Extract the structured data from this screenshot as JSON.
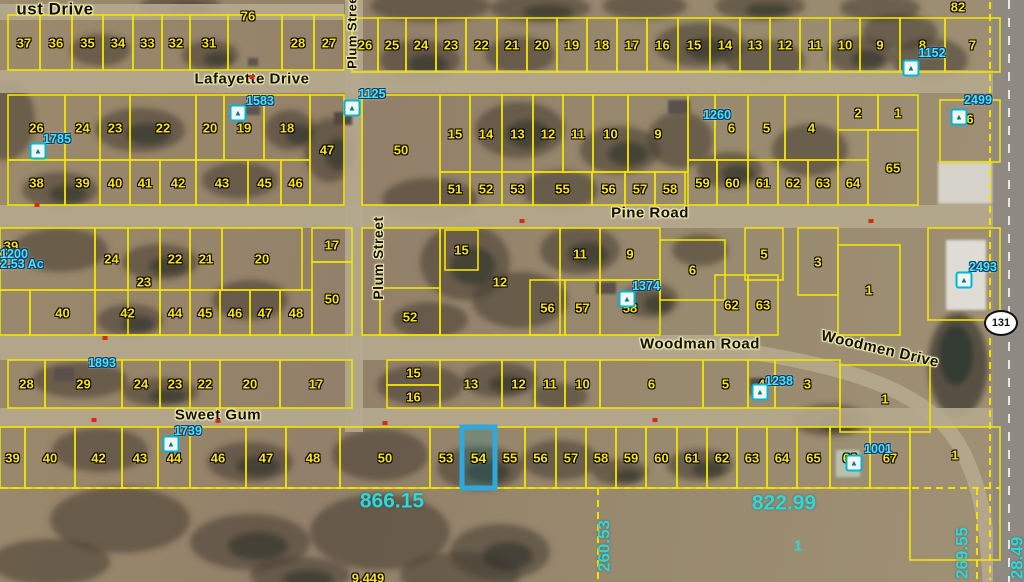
{
  "map": {
    "colors": {
      "parcel_line": "#f2e400",
      "parcel_number": "#ffe600",
      "annotation": "#49e6f5",
      "measurement": "#2ed8d8",
      "highlight": "#2fa8dc",
      "road": "#b5a88e"
    },
    "street_labels": [
      {
        "text": "ust Drive",
        "x": 55,
        "y": 9,
        "size": 17,
        "rot": 0
      },
      {
        "text": "Lafayette Drive",
        "x": 252,
        "y": 79,
        "size": 15,
        "rot": 0
      },
      {
        "text": "Pine Road",
        "x": 650,
        "y": 213,
        "size": 15,
        "rot": 0
      },
      {
        "text": "Woodman Road",
        "x": 700,
        "y": 344,
        "size": 15,
        "rot": 0
      },
      {
        "text": "Woodmen Drive",
        "x": 880,
        "y": 349,
        "size": 15,
        "rot": 13
      },
      {
        "text": "Sweet Gum",
        "x": 218,
        "y": 415,
        "size": 15,
        "rot": 0
      },
      {
        "text": "Plum Street",
        "x": 352,
        "y": 30,
        "size": 13,
        "rot": -90
      },
      {
        "text": "Plum Street",
        "x": 378,
        "y": 258,
        "size": 14,
        "rot": -90
      }
    ],
    "parcel_rows": [
      {
        "y1": 15,
        "y2": 70,
        "cells": [
          [
            8,
            40,
            "37"
          ],
          [
            40,
            72,
            "36"
          ],
          [
            72,
            103,
            "35"
          ],
          [
            103,
            133,
            "34"
          ],
          [
            133,
            162,
            "33"
          ],
          [
            162,
            190,
            "32"
          ],
          [
            190,
            228,
            "31"
          ],
          [
            228,
            282,
            ""
          ],
          [
            282,
            314,
            "28"
          ],
          [
            314,
            344,
            "27"
          ]
        ]
      },
      {
        "y1": 18,
        "y2": 72,
        "cells": [
          [
            352,
            378,
            "26"
          ],
          [
            378,
            406,
            "25"
          ],
          [
            406,
            436,
            "24"
          ],
          [
            436,
            466,
            "23"
          ],
          [
            466,
            497,
            "22"
          ],
          [
            497,
            527,
            "21"
          ],
          [
            527,
            557,
            "20"
          ],
          [
            557,
            587,
            "19"
          ],
          [
            587,
            617,
            "18"
          ],
          [
            617,
            647,
            "17"
          ],
          [
            647,
            678,
            "16"
          ],
          [
            678,
            710,
            "15"
          ],
          [
            710,
            740,
            "14"
          ],
          [
            740,
            770,
            "13"
          ],
          [
            770,
            800,
            "12"
          ],
          [
            800,
            830,
            "11"
          ],
          [
            830,
            860,
            "10"
          ],
          [
            860,
            900,
            "9"
          ],
          [
            900,
            945,
            "8"
          ],
          [
            945,
            1000,
            "7"
          ]
        ]
      },
      {
        "y1": 95,
        "y2": 160,
        "cells": [
          [
            8,
            65,
            "26"
          ],
          [
            65,
            100,
            "24"
          ],
          [
            100,
            130,
            "23"
          ],
          [
            130,
            196,
            "22"
          ],
          [
            196,
            224,
            "20"
          ],
          [
            224,
            264,
            "19"
          ],
          [
            264,
            310,
            "18"
          ]
        ]
      },
      {
        "y1": 95,
        "y2": 205,
        "cells": [
          [
            310,
            344,
            "47"
          ],
          [
            362,
            440,
            "50"
          ]
        ]
      },
      {
        "y1": 160,
        "y2": 205,
        "cells": [
          [
            8,
            65,
            "38"
          ],
          [
            65,
            100,
            "39"
          ],
          [
            100,
            130,
            "40"
          ],
          [
            130,
            160,
            "41"
          ],
          [
            160,
            196,
            "42"
          ],
          [
            196,
            248,
            "43"
          ],
          [
            248,
            281,
            "45"
          ],
          [
            281,
            310,
            "46"
          ]
        ]
      },
      {
        "y1": 95,
        "y2": 172,
        "cells": [
          [
            440,
            470,
            "15"
          ],
          [
            470,
            502,
            "14"
          ],
          [
            502,
            533,
            "13"
          ],
          [
            533,
            563,
            "12"
          ],
          [
            563,
            593,
            "11"
          ],
          [
            593,
            628,
            "10"
          ],
          [
            628,
            688,
            "9"
          ]
        ]
      },
      {
        "y1": 172,
        "y2": 205,
        "cells": [
          [
            440,
            470,
            "51"
          ],
          [
            470,
            502,
            "52"
          ],
          [
            502,
            533,
            "53"
          ],
          [
            533,
            592,
            "55"
          ],
          [
            592,
            625,
            "56"
          ],
          [
            625,
            655,
            "57"
          ],
          [
            655,
            685,
            "58"
          ]
        ]
      },
      {
        "y1": 95,
        "y2": 160,
        "cells": [
          [
            688,
            715,
            ""
          ],
          [
            715,
            748,
            "6"
          ],
          [
            748,
            785,
            "5"
          ],
          [
            785,
            838,
            "4"
          ]
        ]
      },
      {
        "y1": 95,
        "y2": 130,
        "cells": [
          [
            838,
            878,
            "2"
          ],
          [
            878,
            918,
            "1"
          ]
        ]
      },
      {
        "y1": 130,
        "y2": 205,
        "cells": [
          [
            868,
            918,
            "65"
          ]
        ]
      },
      {
        "y1": 160,
        "y2": 205,
        "cells": [
          [
            688,
            717,
            "59"
          ],
          [
            717,
            748,
            "60"
          ],
          [
            748,
            778,
            "61"
          ],
          [
            778,
            808,
            "62"
          ],
          [
            808,
            838,
            "63"
          ],
          [
            838,
            868,
            "64"
          ]
        ]
      },
      {
        "y1": 100,
        "y2": 162,
        "cells": [
          [
            940,
            1000,
            "6",
            119
          ]
        ]
      },
      {
        "y1": 228,
        "y2": 290,
        "cells": [
          [
            0,
            95,
            ""
          ],
          [
            95,
            128,
            "24"
          ],
          [
            160,
            190,
            "22"
          ],
          [
            190,
            222,
            "21"
          ],
          [
            222,
            302,
            "20"
          ]
        ]
      },
      {
        "y1": 228,
        "y2": 335,
        "cells": [
          [
            128,
            160,
            "23"
          ],
          [
            362,
            440,
            ""
          ],
          [
            440,
            560,
            "12"
          ]
        ]
      },
      {
        "y1": 228,
        "y2": 262,
        "cells": [
          [
            312,
            352,
            "17"
          ]
        ]
      },
      {
        "y1": 262,
        "y2": 335,
        "cells": [
          [
            312,
            352,
            "50"
          ]
        ]
      },
      {
        "y1": 290,
        "y2": 335,
        "cells": [
          [
            0,
            30,
            ""
          ],
          [
            30,
            95,
            "40"
          ],
          [
            95,
            160,
            "42"
          ],
          [
            160,
            190,
            "44"
          ],
          [
            190,
            220,
            "45"
          ],
          [
            220,
            250,
            "46"
          ],
          [
            250,
            280,
            "47"
          ],
          [
            280,
            312,
            "48"
          ]
        ]
      },
      {
        "y1": 288,
        "y2": 335,
        "cells": [
          [
            380,
            440,
            "52",
            317
          ]
        ]
      },
      {
        "y1": 230,
        "y2": 270,
        "cells": [
          [
            445,
            478,
            "15"
          ]
        ]
      },
      {
        "y1": 228,
        "y2": 280,
        "cells": [
          [
            560,
            600,
            "11"
          ],
          [
            600,
            660,
            "9"
          ],
          [
            745,
            783,
            "5"
          ]
        ]
      },
      {
        "y1": 240,
        "y2": 300,
        "cells": [
          [
            660,
            725,
            "6"
          ]
        ]
      },
      {
        "y1": 280,
        "y2": 335,
        "cells": [
          [
            530,
            565,
            "56"
          ],
          [
            565,
            600,
            "57"
          ],
          [
            600,
            660,
            "58"
          ]
        ]
      },
      {
        "y1": 228,
        "y2": 295,
        "cells": [
          [
            798,
            838,
            "3"
          ]
        ]
      },
      {
        "y1": 245,
        "y2": 335,
        "cells": [
          [
            838,
            900,
            "1"
          ]
        ]
      },
      {
        "y1": 275,
        "y2": 335,
        "cells": [
          [
            715,
            748,
            "62"
          ],
          [
            748,
            778,
            "63"
          ]
        ]
      },
      {
        "y1": 228,
        "y2": 320,
        "cells": [
          [
            928,
            1000,
            ""
          ]
        ]
      },
      {
        "y1": 360,
        "y2": 408,
        "cells": [
          [
            8,
            45,
            "28"
          ],
          [
            45,
            122,
            "29"
          ],
          [
            122,
            160,
            "24"
          ],
          [
            160,
            190,
            "23"
          ],
          [
            190,
            220,
            "22"
          ],
          [
            220,
            280,
            "20"
          ],
          [
            280,
            352,
            "17"
          ]
        ]
      },
      {
        "y1": 360,
        "y2": 385,
        "cells": [
          [
            387,
            440,
            "15"
          ]
        ]
      },
      {
        "y1": 385,
        "y2": 408,
        "cells": [
          [
            387,
            440,
            "16"
          ]
        ]
      },
      {
        "y1": 360,
        "y2": 408,
        "cells": [
          [
            440,
            502,
            "13"
          ],
          [
            502,
            535,
            "12"
          ],
          [
            535,
            565,
            "11"
          ],
          [
            565,
            600,
            "10"
          ],
          [
            600,
            703,
            "6"
          ],
          [
            703,
            748,
            "5"
          ],
          [
            748,
            775,
            "4"
          ],
          [
            775,
            840,
            "3"
          ]
        ]
      },
      {
        "y1": 365,
        "y2": 432,
        "cells": [
          [
            840,
            930,
            "1"
          ]
        ]
      },
      {
        "y1": 427,
        "y2": 488,
        "cells": [
          [
            0,
            25,
            "39"
          ],
          [
            25,
            75,
            "40"
          ],
          [
            75,
            122,
            "42"
          ],
          [
            122,
            158,
            "43"
          ],
          [
            158,
            190,
            "44"
          ],
          [
            190,
            246,
            "46"
          ],
          [
            246,
            286,
            "47"
          ],
          [
            286,
            340,
            "48"
          ],
          [
            340,
            430,
            "50"
          ],
          [
            430,
            462,
            "53"
          ],
          [
            495,
            525,
            "55"
          ],
          [
            525,
            556,
            "56"
          ],
          [
            556,
            586,
            "57"
          ],
          [
            586,
            616,
            "58"
          ],
          [
            616,
            646,
            "59"
          ],
          [
            646,
            677,
            "60"
          ],
          [
            677,
            707,
            "61"
          ],
          [
            707,
            737,
            "62"
          ],
          [
            737,
            767,
            "63"
          ],
          [
            767,
            797,
            "64"
          ],
          [
            797,
            830,
            "65"
          ],
          [
            830,
            870,
            "66"
          ],
          [
            870,
            910,
            "67"
          ]
        ]
      },
      {
        "y1": 427,
        "y2": 560,
        "cells": [
          [
            910,
            1000,
            "1",
            455
          ]
        ]
      }
    ],
    "highlight": {
      "label": "54",
      "x1": 462,
      "y1": 427,
      "x2": 495,
      "y2": 488
    },
    "extra_numbers": [
      {
        "text": "76",
        "x": 248,
        "y": 16
      },
      {
        "text": "82",
        "x": 958,
        "y": 7
      },
      {
        "text": "39",
        "x": 11,
        "y": 246
      },
      {
        "text": "9.449",
        "x": 368,
        "y": 578
      }
    ],
    "annotations": [
      {
        "text": "1583",
        "x": 260,
        "y": 101
      },
      {
        "text": "1125",
        "x": 372,
        "y": 94
      },
      {
        "text": "1785",
        "x": 57,
        "y": 139
      },
      {
        "text": "1152",
        "x": 932,
        "y": 53
      },
      {
        "text": "2499",
        "x": 978,
        "y": 100
      },
      {
        "text": "1260",
        "x": 717,
        "y": 115
      },
      {
        "text": "1374",
        "x": 646,
        "y": 286
      },
      {
        "text": "2493",
        "x": 983,
        "y": 267
      },
      {
        "text": "1200",
        "x": 14,
        "y": 254
      },
      {
        "text": "2.53 Ac",
        "x": 22,
        "y": 264
      },
      {
        "text": "1893",
        "x": 102,
        "y": 363
      },
      {
        "text": "1238",
        "x": 779,
        "y": 381
      },
      {
        "text": "1739",
        "x": 188,
        "y": 431
      },
      {
        "text": "1001",
        "x": 878,
        "y": 449
      }
    ],
    "measurements": [
      {
        "text": "866.15",
        "x": 392,
        "y": 501,
        "rot": 0,
        "vert": false
      },
      {
        "text": "822.99",
        "x": 784,
        "y": 503,
        "rot": 0,
        "vert": false
      },
      {
        "text": "260.53",
        "x": 604,
        "y": 546,
        "rot": -90,
        "vert": true
      },
      {
        "text": "269.55",
        "x": 962,
        "y": 553,
        "rot": -90,
        "vert": true
      },
      {
        "text": "28.49",
        "x": 1017,
        "y": 558,
        "rot": -90,
        "vert": true
      }
    ],
    "field_number": {
      "text": "1",
      "x": 798,
      "y": 546
    },
    "highway_shield": {
      "text": "131",
      "x": 1001,
      "y": 323
    },
    "poi_markers": [
      {
        "x": 911,
        "y": 68
      },
      {
        "x": 238,
        "y": 113
      },
      {
        "x": 38,
        "y": 151
      },
      {
        "x": 352,
        "y": 108
      },
      {
        "x": 959,
        "y": 117
      },
      {
        "x": 627,
        "y": 299
      },
      {
        "x": 964,
        "y": 280
      },
      {
        "x": 760,
        "y": 392
      },
      {
        "x": 171,
        "y": 444
      },
      {
        "x": 854,
        "y": 463
      }
    ],
    "road_marks": [
      {
        "x": 252,
        "y": 77
      },
      {
        "x": 522,
        "y": 221
      },
      {
        "x": 871,
        "y": 221
      },
      {
        "x": 37,
        "y": 205
      },
      {
        "x": 105,
        "y": 338
      },
      {
        "x": 94,
        "y": 420
      },
      {
        "x": 218,
        "y": 421
      },
      {
        "x": 385,
        "y": 423
      },
      {
        "x": 655,
        "y": 420
      }
    ],
    "roads": {
      "horizontal_bands": [
        [
          0,
          4,
          344,
          16
        ],
        [
          0,
          70,
          1000,
          23
        ],
        [
          0,
          205,
          1000,
          23
        ],
        [
          0,
          335,
          760,
          25
        ],
        [
          0,
          408,
          1000,
          19
        ]
      ],
      "vertical_bands": [
        [
          345,
          0,
          18,
          432
        ]
      ],
      "curve_path": "M750,352 C840,366 922,388 956,440 C980,478 988,528 990,582",
      "highway": {
        "x": 993,
        "w": 31
      }
    },
    "dashed_lines": [
      [
        0,
        488,
        1000,
        488
      ],
      [
        598,
        488,
        598,
        582
      ],
      [
        977,
        488,
        977,
        582
      ],
      [
        990,
        2,
        990,
        580
      ]
    ]
  }
}
